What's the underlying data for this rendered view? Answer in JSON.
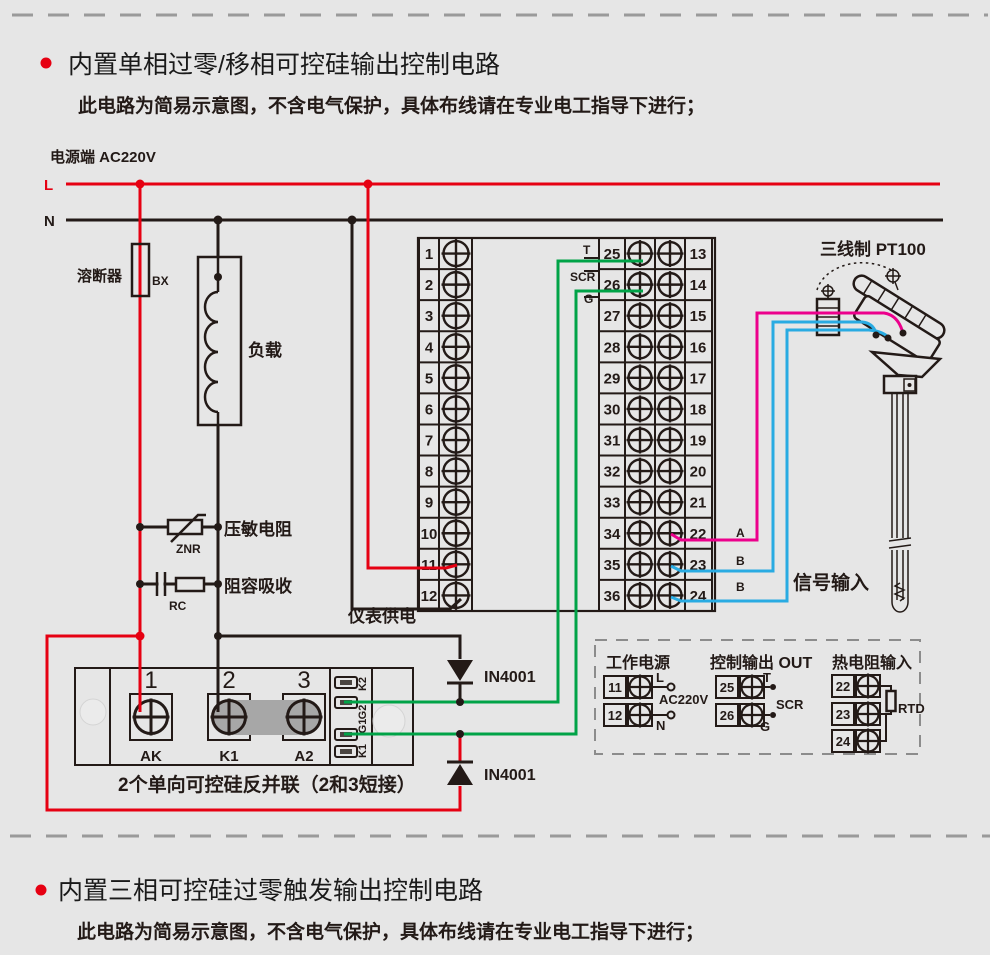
{
  "colors": {
    "background": "#e6e6e6",
    "ink": "#231a17",
    "wire_red": "#e60012",
    "wire_green": "#00a347",
    "wire_blue": "#29abe2",
    "wire_pink": "#ec008c",
    "bullet": "#e60012"
  },
  "section1": {
    "title": "内置单相过零/移相可控硅输出控制电路",
    "subtitle": "此电路为简易示意图，不含电气保护，具体布线请在专业电工指导下进行；"
  },
  "section2": {
    "title": "内置三相可控硅过零触发输出控制电路",
    "subtitle": "此电路为简易示意图，不含电气保护，具体布线请在专业电工指导下进行；"
  },
  "power": {
    "label": "电源端  AC220V",
    "l": "L",
    "n": "N"
  },
  "components": {
    "fuse": "溶断器",
    "fuse_code": "BX",
    "load": "负载",
    "varistor": "压敏电阻",
    "varistor_code": "ZNR",
    "rc": "阻容吸收",
    "rc_code": "RC",
    "meter_supply": "仪表供电",
    "diode1": "IN4001",
    "diode2": "IN4001"
  },
  "terminal_block": {
    "left": [
      "1",
      "2",
      "3",
      "4",
      "5",
      "6",
      "7",
      "8",
      "9",
      "10",
      "11",
      "12"
    ],
    "mid": [
      "25",
      "26",
      "27",
      "28",
      "29",
      "30",
      "31",
      "32",
      "33",
      "34",
      "35",
      "36"
    ],
    "right": [
      "13",
      "14",
      "15",
      "16",
      "17",
      "18",
      "19",
      "20",
      "21",
      "22",
      "23",
      "24"
    ],
    "out_labels": {
      "t": "T",
      "scr": "SCR",
      "g": "G"
    },
    "signal_labels": [
      "A",
      "B",
      "B"
    ]
  },
  "sensor": {
    "title": "三线制 PT100",
    "signal_input": "信号输入"
  },
  "scr_module": {
    "terminals": [
      "1",
      "2",
      "3"
    ],
    "terminal_names": [
      "AK",
      "K1",
      "A2"
    ],
    "side_labels": [
      "K2",
      "G2",
      "G1",
      "K1"
    ],
    "caption": "2个单向可控硅反并联（2和3短接）"
  },
  "legend": {
    "power": {
      "title": "工作电源",
      "rows": [
        "11",
        "12"
      ],
      "l": "L",
      "voltage": "AC220V",
      "n": "N"
    },
    "output": {
      "title": "控制输出 OUT",
      "rows": [
        "25",
        "26"
      ],
      "t": "T",
      "scr": "SCR",
      "g": "G"
    },
    "rtd": {
      "title": "热电阻输入",
      "rows": [
        "22",
        "23",
        "24"
      ],
      "label": "RTD"
    }
  }
}
